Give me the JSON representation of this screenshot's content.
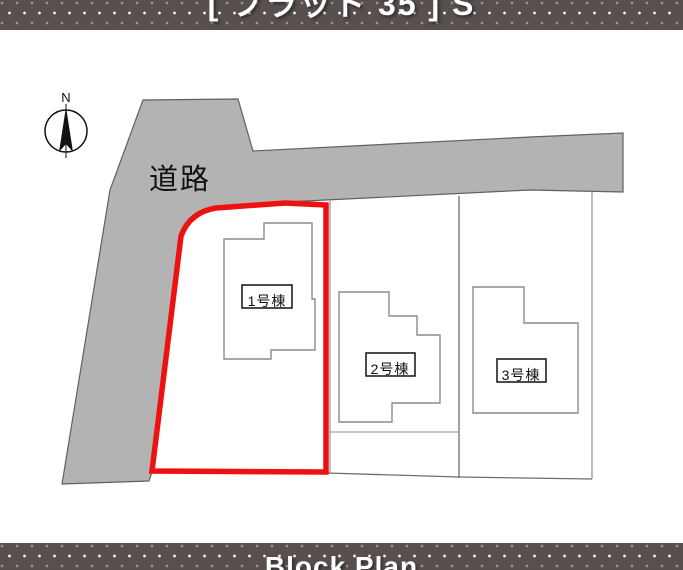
{
  "header": {
    "title": "[ フラット 35 ] S"
  },
  "footer": {
    "title": "Block Plan"
  },
  "plan": {
    "compass_label": "N",
    "road_label": "道路",
    "buildings": [
      {
        "label": "1号棟",
        "highlighted": true
      },
      {
        "label": "2号棟",
        "highlighted": false
      },
      {
        "label": "3号棟",
        "highlighted": false
      }
    ]
  },
  "colors": {
    "band_bg": "#57504e",
    "road_fill": "#b3b3b3",
    "road_stroke": "#606060",
    "lot_line": "#999999",
    "house_line": "#8c8c8c",
    "highlight_red": "#ee1111",
    "label_box_border": "#111111"
  }
}
